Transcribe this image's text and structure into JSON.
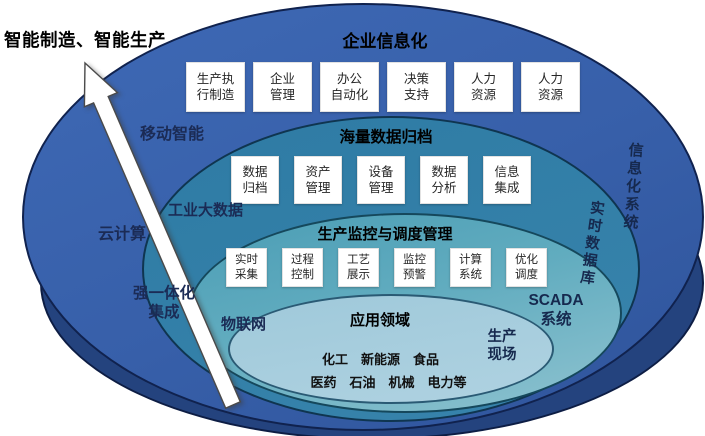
{
  "main_title": "智能制造、智能生产",
  "layers": {
    "enterprise": {
      "title": "企业信息化",
      "boxes": [
        "生产执\n行制造",
        "企业\n管理",
        "办公\n自动化",
        "决策\n支持",
        "人力\n资源",
        "人力\n资源"
      ]
    },
    "archive": {
      "title": "海量数据归档",
      "boxes": [
        "数据\n归档",
        "资产\n管理",
        "设备\n管理",
        "数据\n分析",
        "信息\n集成"
      ]
    },
    "monitor": {
      "title": "生产监控与调度管理",
      "boxes": [
        "实时\n采集",
        "过程\n控制",
        "工艺\n展示",
        "监控\n预警",
        "计算\n系统",
        "优化\n调度"
      ]
    },
    "application": {
      "title": "应用领域",
      "industries_line1": "化工　新能源　食品",
      "industries_line2": "医药　石油　机械　电力等"
    }
  },
  "side_labels": {
    "mobile": "移动智能",
    "cloud": "云计算",
    "industrial_bigdata": "工业大数据",
    "integration": "强一体化\n集成",
    "iot": "物联网",
    "info_system": "信息化系统",
    "realtime_db": "实时数据库",
    "scada": "SCADA\n系统",
    "production_site": "生产\n现场"
  },
  "colors": {
    "outer_ring": "#24437E",
    "enterprise_ring": "#3A63AE",
    "archive_ring": "#327FA7",
    "monitor_ring": "#5FA9BE",
    "application_ring": "#A9CFDE",
    "box_background": "#FFFFFF",
    "title_text": "#000000",
    "side_label_text": "#1B2B55"
  }
}
